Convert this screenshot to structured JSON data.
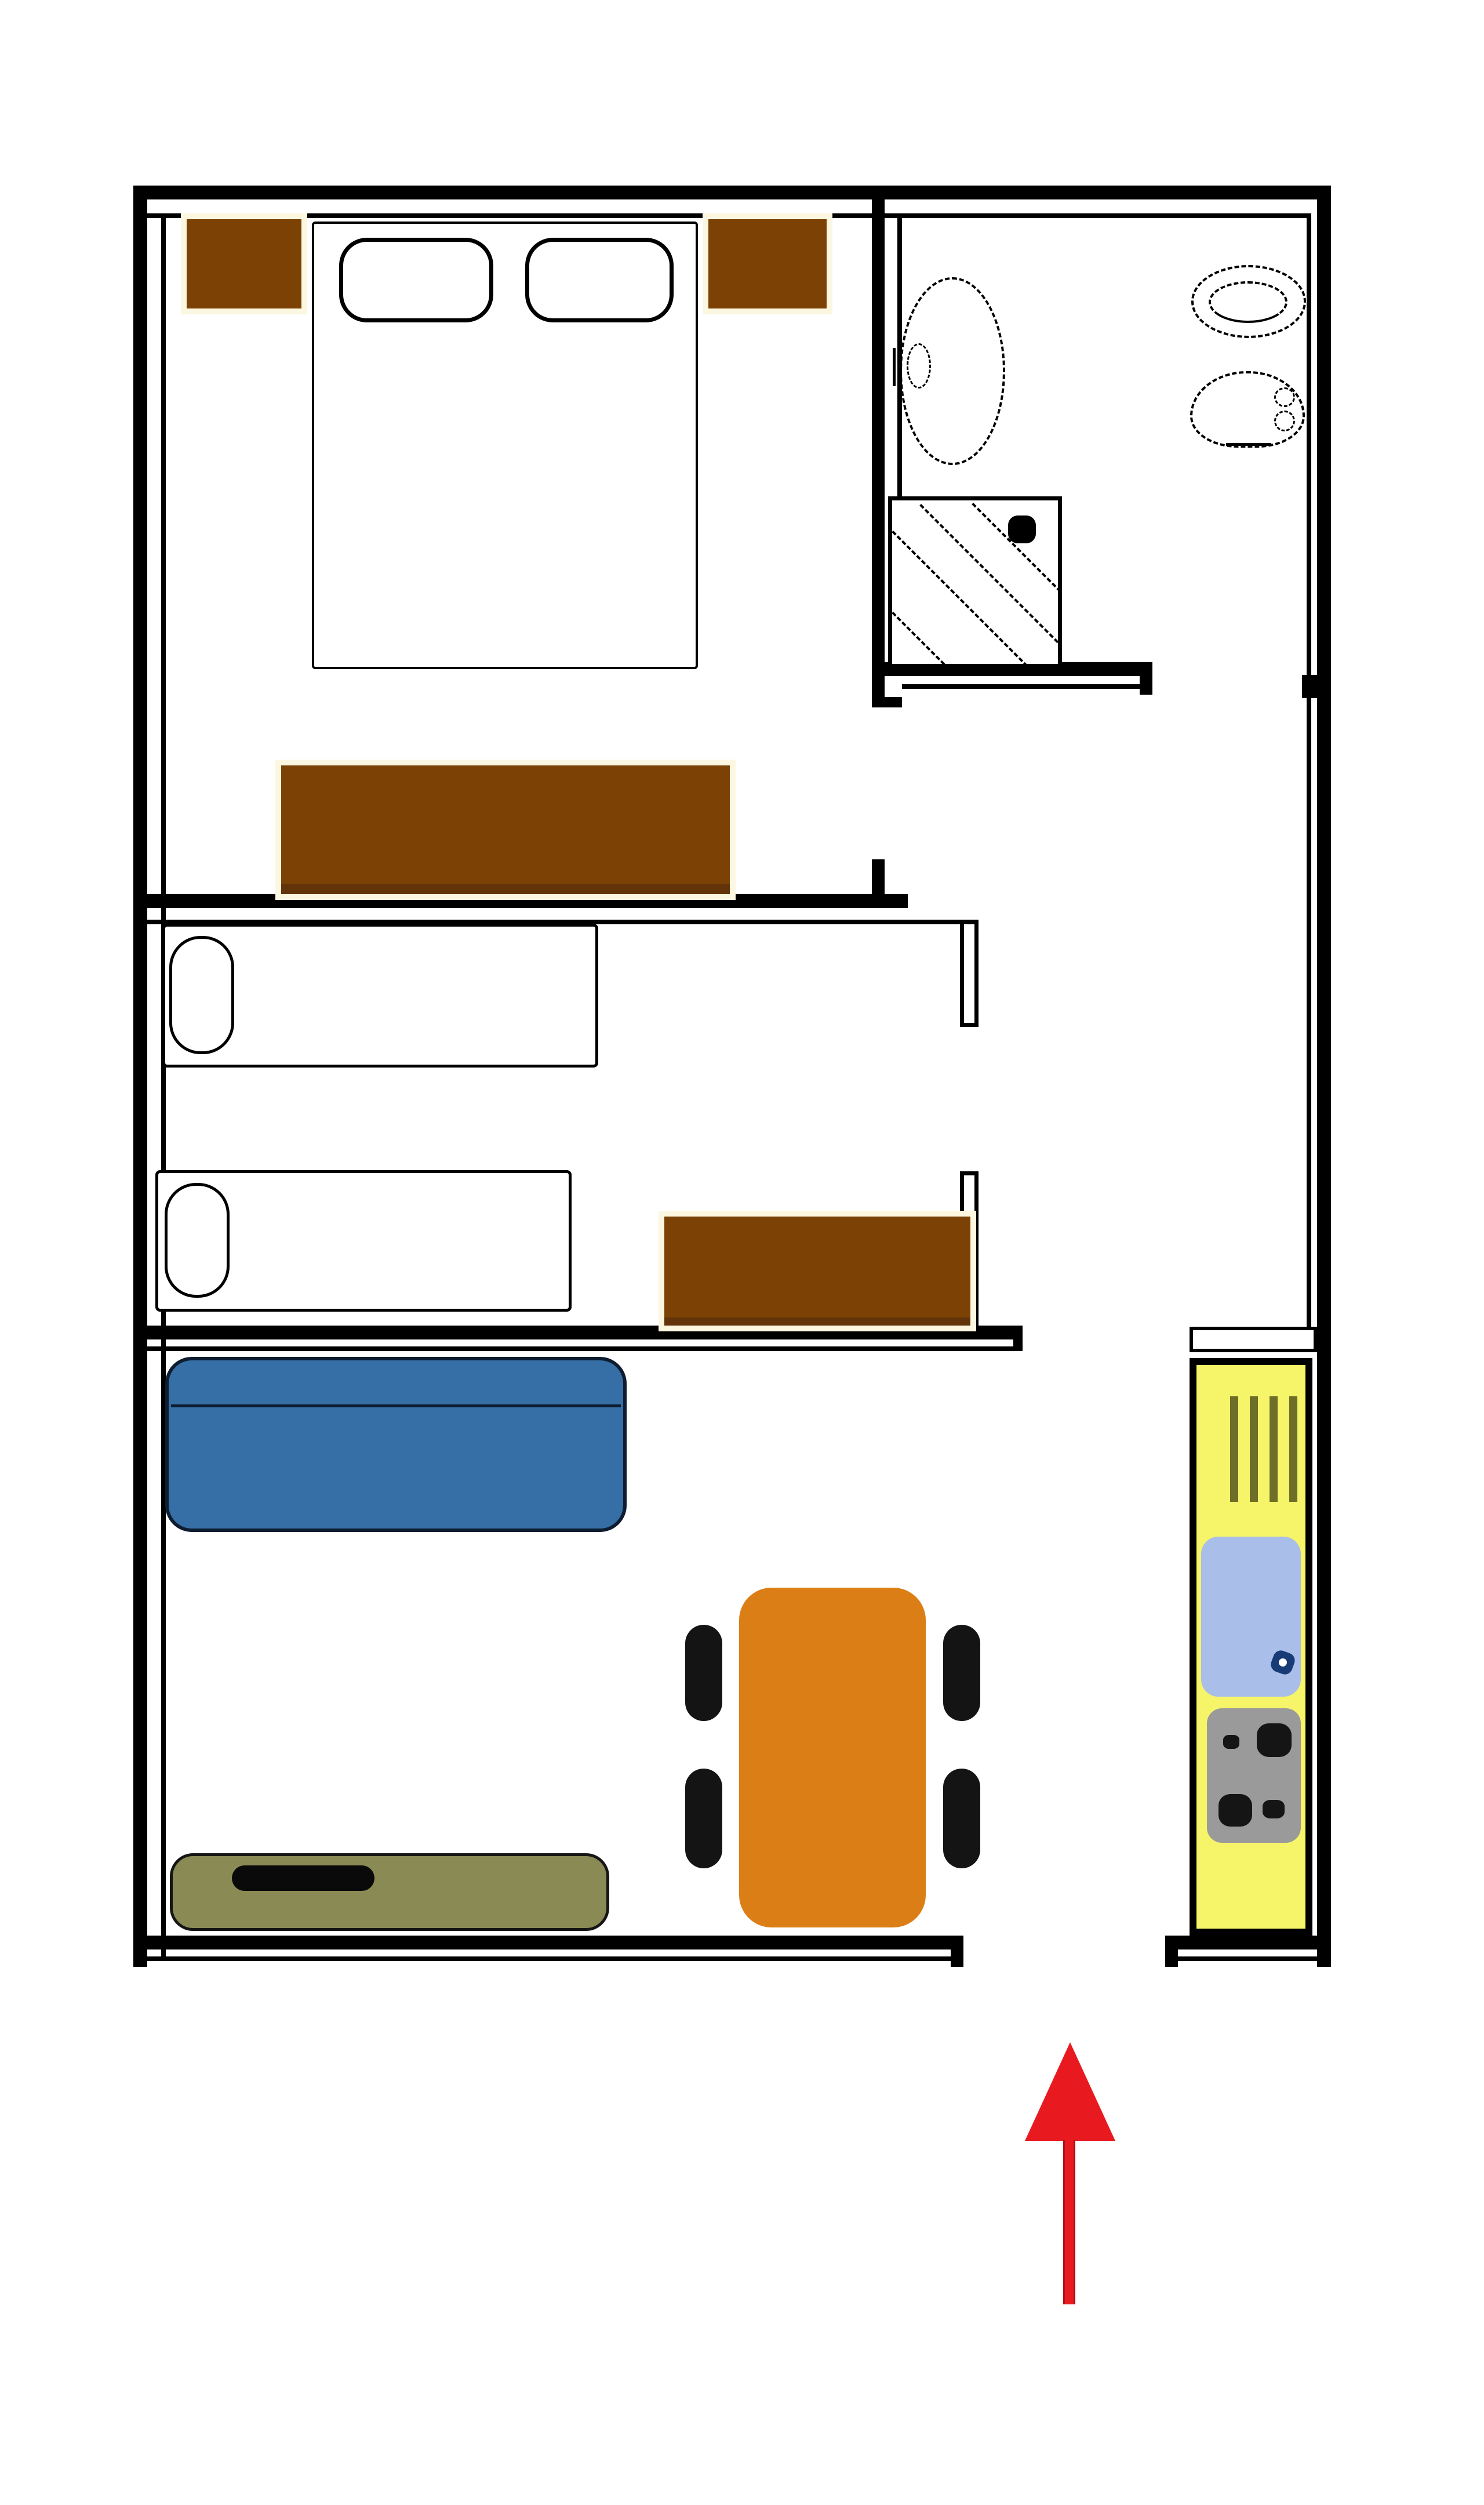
{
  "plan": {
    "type": "apartment-floor-plan",
    "style": "hand-drawn raster plan, no text labels",
    "entrance": "door gap in bottom wall marked by upward red arrow"
  },
  "colors": {
    "wall": "#000000",
    "floor": "#ffffff",
    "brown": "#7c4205",
    "brown_dark": "#63340a",
    "cream": "#fcf7e0",
    "sofa": "#356fa5",
    "sofa_line": "#0e1c30",
    "bench": "#8a8a55",
    "bench_line": "#161616",
    "object": "#0a0a0a",
    "table": "#dc7e16",
    "chair": "#141414",
    "kyellow": "#f6f468",
    "rack": "#6e6e28",
    "sink": "#a9bee8",
    "faucet": "#173b77",
    "stove": "#9a9a9a",
    "burner": "#151515",
    "red": "#e81a20",
    "red_dark": "#b01116"
  },
  "areas": [
    {
      "name": "bedroom",
      "items": [
        "double-bed",
        "pillow-left",
        "pillow-right",
        "nightstand-left",
        "nightstand-right",
        "dresser"
      ]
    },
    {
      "name": "bathroom",
      "items": [
        "washbasin",
        "faucet",
        "toilet",
        "bidet",
        "shower",
        "shower-head-dot"
      ]
    },
    {
      "name": "twin-room",
      "items": [
        "single-bed-1",
        "single-bed-2",
        "side-chest"
      ]
    },
    {
      "name": "living-room",
      "items": [
        "sofa",
        "dining-table",
        "chair-top-left",
        "chair-bottom-left",
        "chair-top-right",
        "chair-bottom-right",
        "low-bench",
        "bench-object"
      ]
    },
    {
      "name": "kitchen",
      "items": [
        "dish-rack",
        "kitchen-sink",
        "tap-symbol",
        "stove",
        "burner-large-1",
        "burner-small-1",
        "burner-large-2",
        "burner-small-2"
      ]
    },
    {
      "name": "entrance",
      "items": [
        "entry-arrow"
      ]
    }
  ]
}
